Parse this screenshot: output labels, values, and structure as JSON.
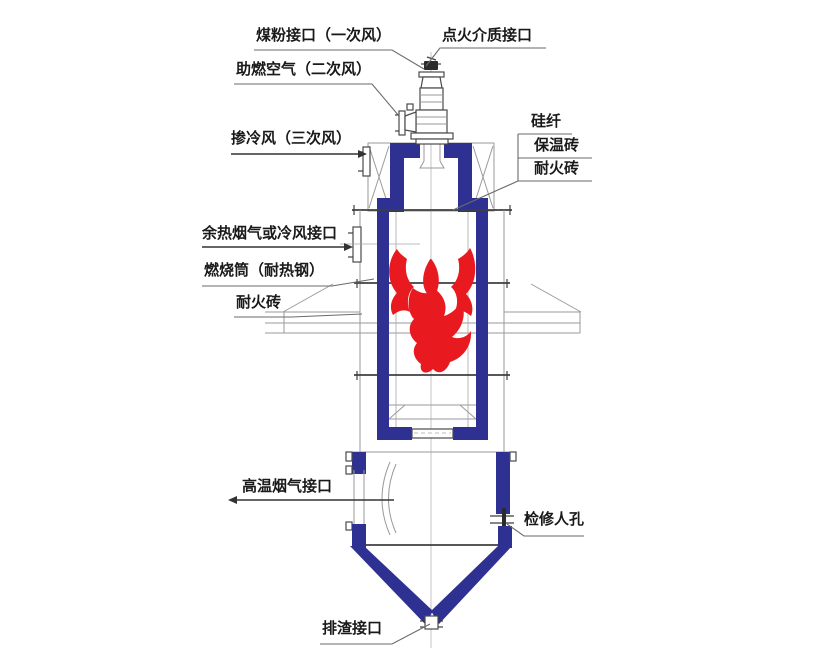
{
  "colors": {
    "structure_blue": "#2e3192",
    "flame_red": "#e8191f",
    "line_dark": "#3f3f3f",
    "line_gray": "#9a9a9a",
    "text": "#1a1a1a"
  },
  "labels": {
    "coal_inlet": "煤粉接口（一次风）",
    "ignition_medium": "点火介质接口",
    "secondary_air": "助燃空气（二次风）",
    "tertiary_air": "掺冷风（三次风）",
    "silica_fiber": "硅纤",
    "insulation_brick": "保温砖",
    "refractory_brick_right": "耐火砖",
    "waste_heat_or_cold_air_inlet": "余热烟气或冷风接口",
    "combustion_cylinder": "燃烧筒（耐热钢）",
    "refractory_brick_left": "耐火砖",
    "high_temp_flue_gas_outlet": "高温烟气接口",
    "inspection_manhole": "检修人孔",
    "slag_outlet": "排渣接口"
  }
}
